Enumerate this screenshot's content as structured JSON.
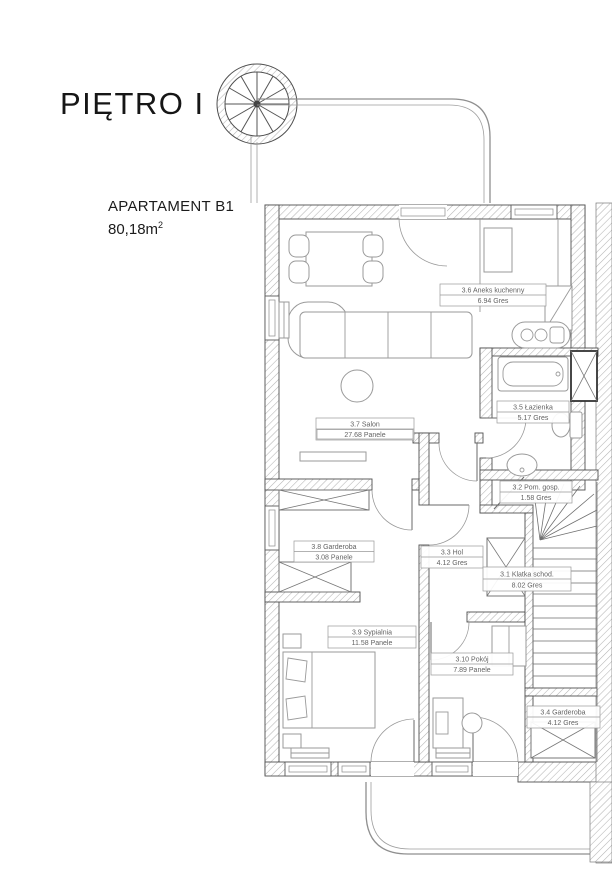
{
  "header": {
    "floor_title": "PIĘTRO I"
  },
  "apartment": {
    "name": "APARTAMENT B1",
    "area_value": "80,18m",
    "area_sup": "2"
  },
  "rooms": [
    {
      "label": "3.6 Aneks kuchenny",
      "detail": "6.94 Gres"
    },
    {
      "label": "3.7 Salon",
      "detail": "27.68 Panele"
    },
    {
      "label": "3.5 Łazienka",
      "detail": "5.17 Gres"
    },
    {
      "label": "3.2 Pom. gosp.",
      "detail": "1.58 Gres"
    },
    {
      "label": "3.8 Garderoba",
      "detail": "3.08 Panele"
    },
    {
      "label": "3.3 Hol",
      "detail": "4.12 Gres"
    },
    {
      "label": "3.1 Klatka schod.",
      "detail": "8.02 Gres"
    },
    {
      "label": "3.9 Sypialnia",
      "detail": "11.58 Panele"
    },
    {
      "label": "3.10 Pokój",
      "detail": "7.89 Panele"
    },
    {
      "label": "3.4 Garderoba",
      "detail": "4.12 Gres"
    }
  ],
  "colors": {
    "wall_outline": "#4f4f4f",
    "hatch": "#b5b5b5",
    "furniture": "#9a9a9a",
    "label_text": "#636363",
    "title_text": "#161616"
  }
}
